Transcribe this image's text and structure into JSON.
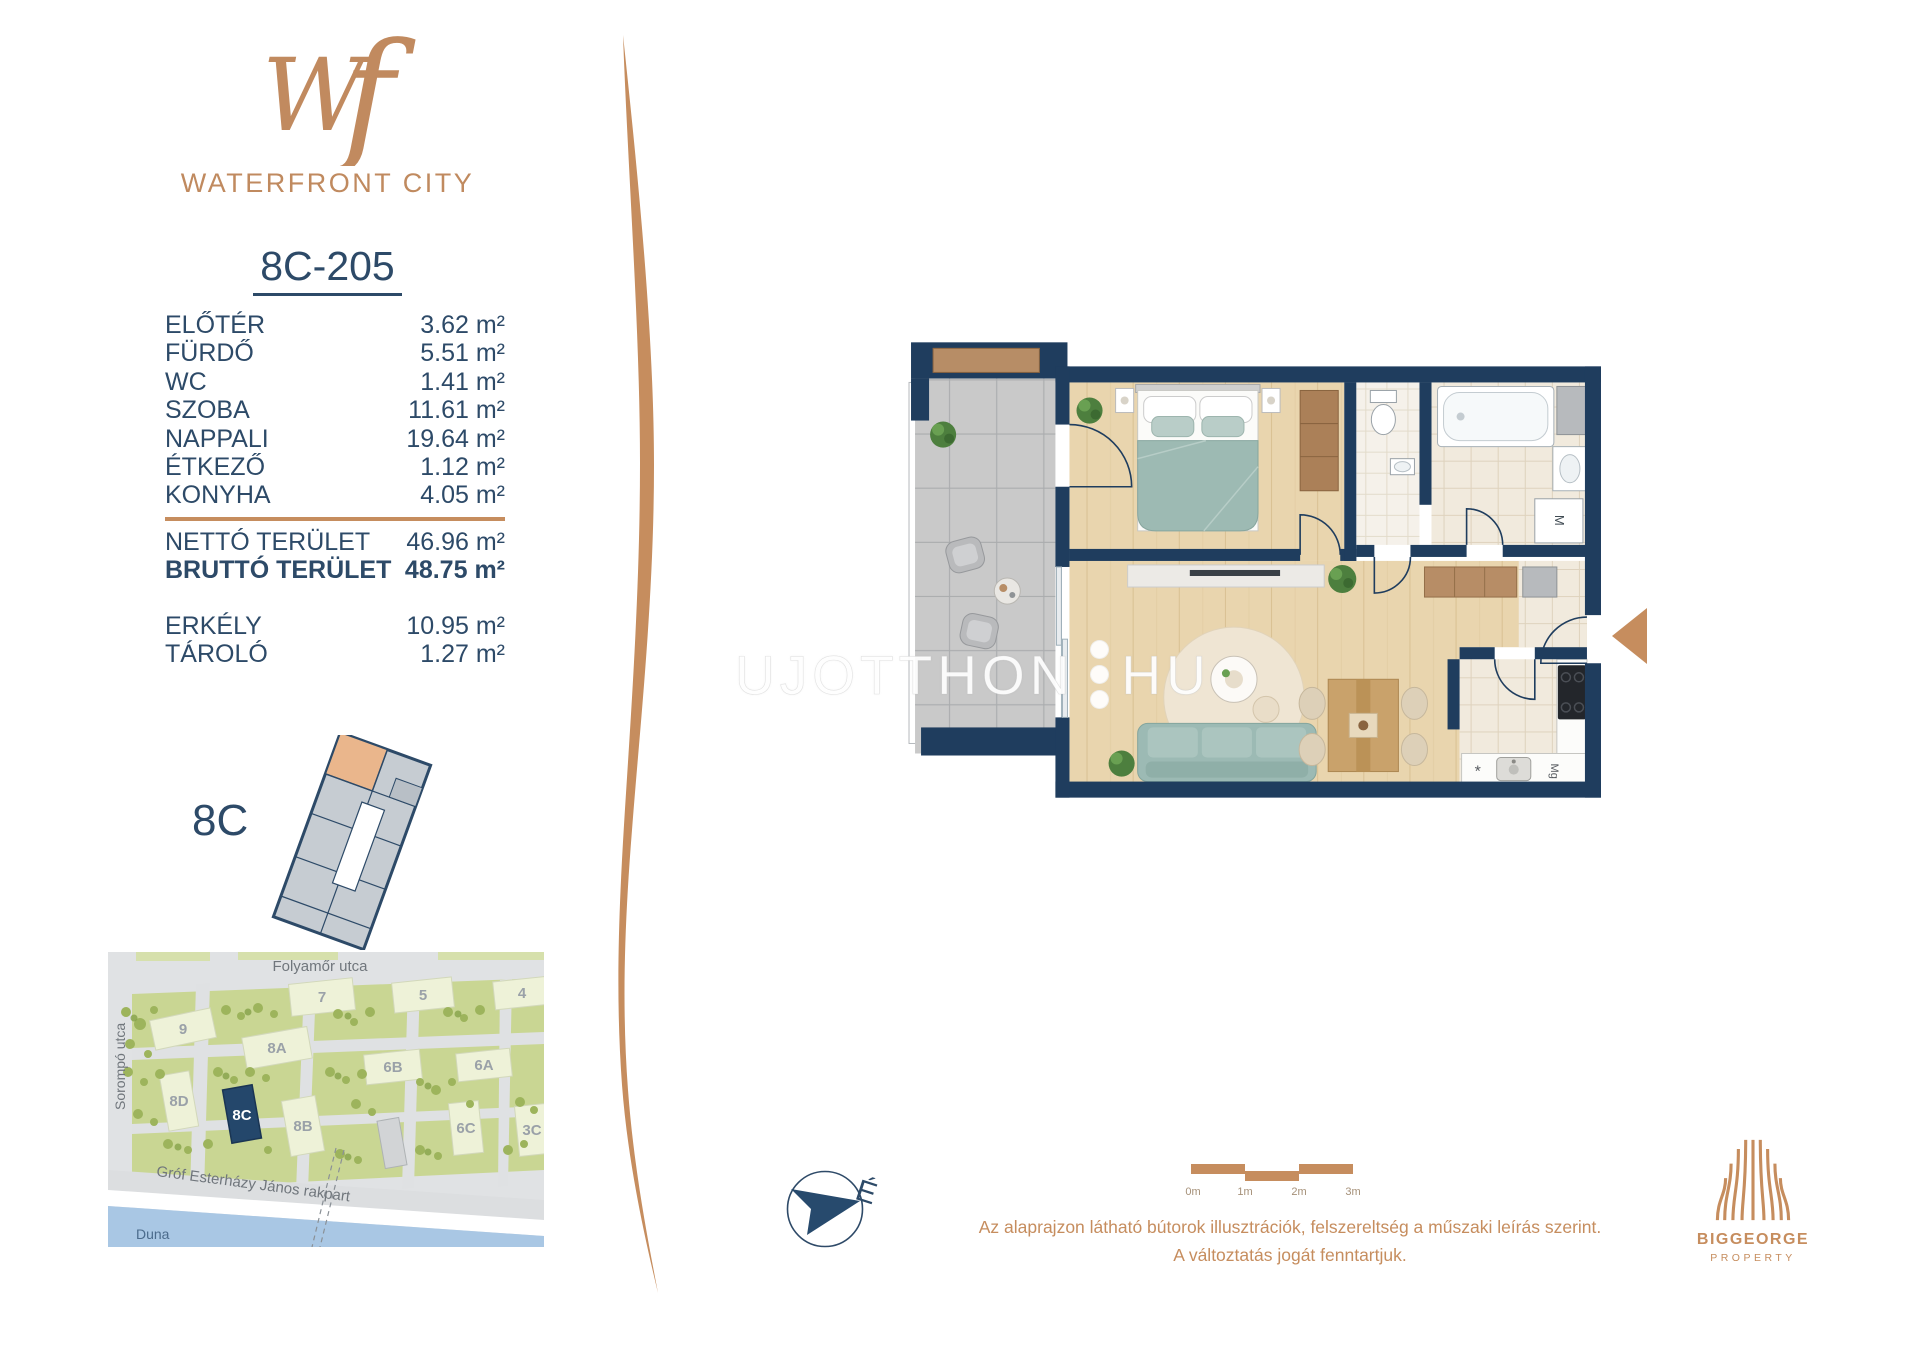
{
  "brand": {
    "monogram_w": "W",
    "monogram_f": "f",
    "name": "WATERFRONT CITY"
  },
  "unit": {
    "id": "8C-205",
    "area_unit": "m²"
  },
  "area_table": {
    "rooms": [
      {
        "label": "ELŐTÉR",
        "value": "3.62"
      },
      {
        "label": "FÜRDŐ",
        "value": "5.51"
      },
      {
        "label": "WC",
        "value": "1.41"
      },
      {
        "label": "SZOBA",
        "value": "11.61"
      },
      {
        "label": "NAPPALI",
        "value": "19.64"
      },
      {
        "label": "ÉTKEZŐ",
        "value": "1.12"
      },
      {
        "label": "KONYHA",
        "value": "4.05"
      }
    ],
    "totals": [
      {
        "label": "NETTÓ TERÜLET",
        "value": "46.96"
      },
      {
        "label": "BRUTTÓ TERÜLET",
        "value": "48.75"
      }
    ],
    "extras": [
      {
        "label": "ERKÉLY",
        "value": "10.95"
      },
      {
        "label": "TÁROLÓ",
        "value": "1.27"
      }
    ]
  },
  "keyplan": {
    "label": "8C"
  },
  "sitemap": {
    "street_top": "Folyamőr utca",
    "street_left": "Sorompó utca",
    "street_bottom": "Gróf Esterházy János rakpart",
    "river": "Duna",
    "buildings": [
      "9",
      "7",
      "5",
      "4",
      "8A",
      "6B",
      "6A",
      "8D",
      "8C",
      "8B",
      "6C",
      "3C"
    ],
    "highlighted": "8C"
  },
  "floorplan": {
    "watermark_left": "UJOTTHON",
    "watermark_right": "HU",
    "washer_label": "M",
    "microwave_label": "Mg",
    "counter_symbol": "*"
  },
  "compass": {
    "north_label": "É"
  },
  "scale_bar": {
    "ticks": [
      "0m",
      "1m",
      "2m",
      "3m"
    ]
  },
  "disclaimer": {
    "line1": "Az alaprajzon látható bútorok illusztrációk, felszereltség a műszaki leírás szerint.",
    "line2": "A változtatás jogát fenntartjuk."
  },
  "developer": {
    "name": "BIGGEORGE",
    "division": "PROPERTY"
  },
  "colors": {
    "accent_tan": "#c68d5e",
    "navy": "#2d4a68",
    "highlight_navy": "#24476b",
    "river_blue": "#a9c7e4"
  }
}
